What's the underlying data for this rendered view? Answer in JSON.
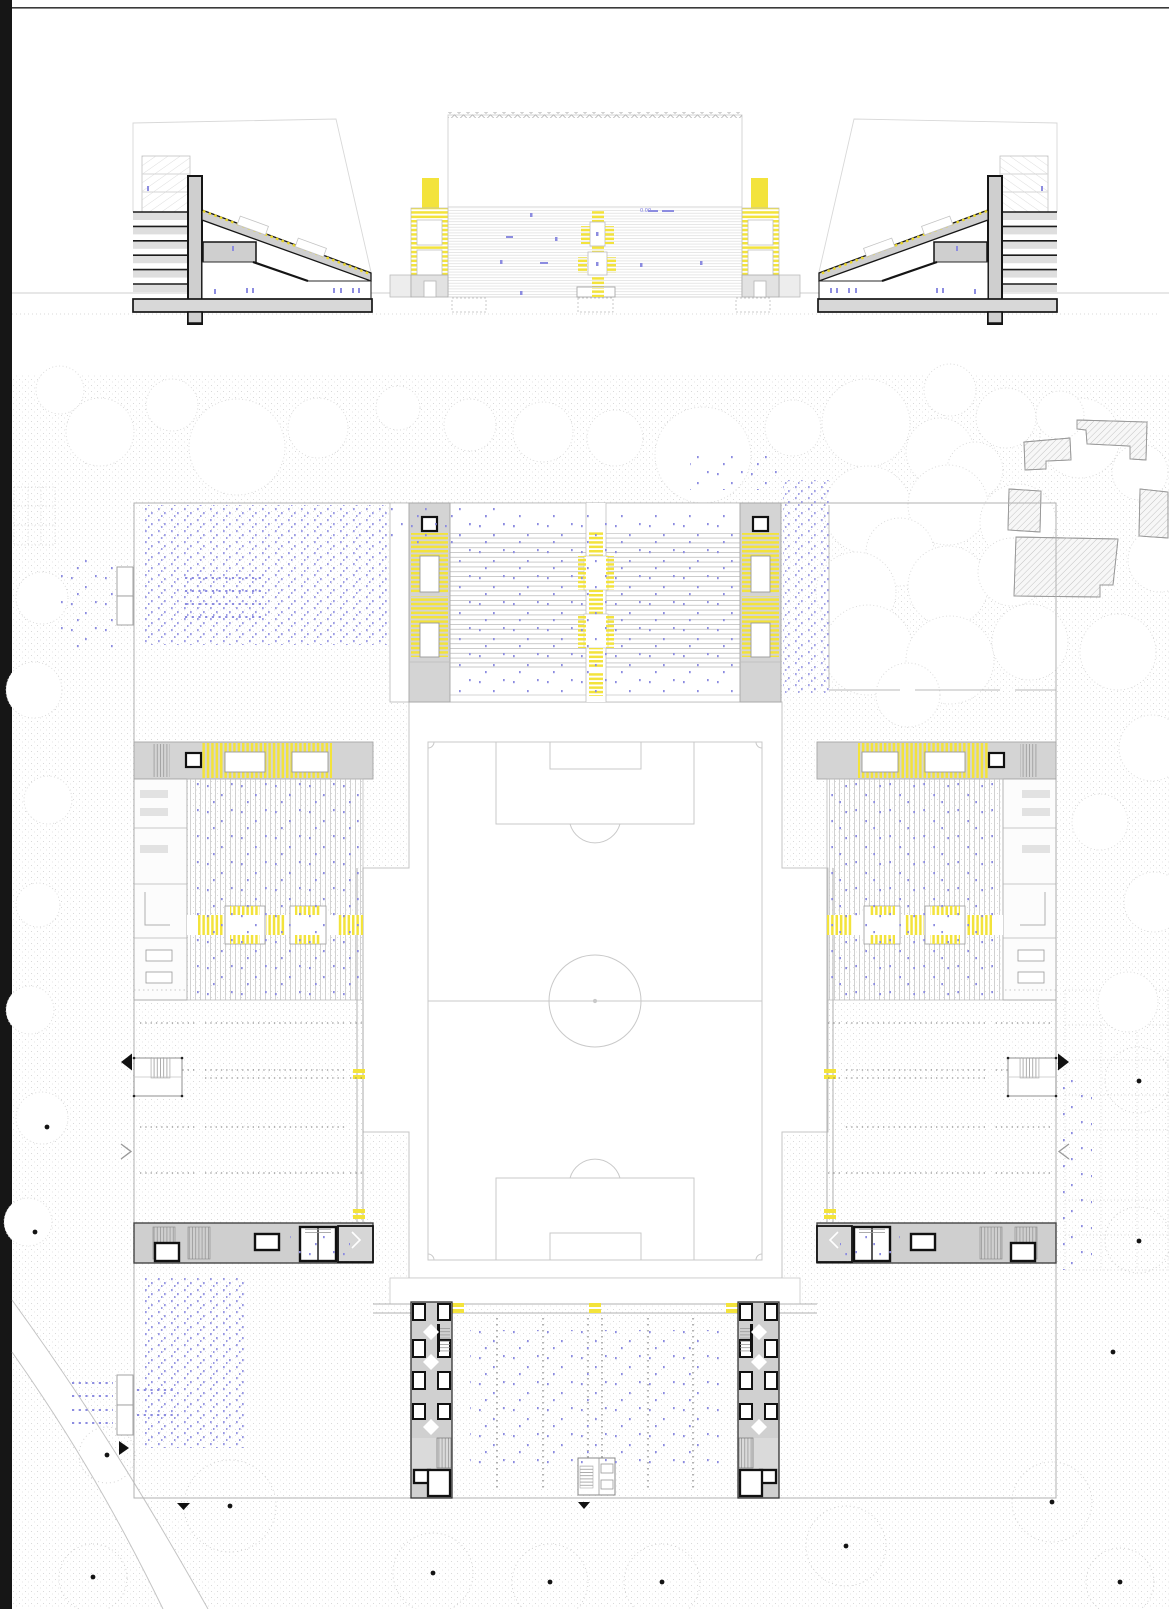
{
  "drawing": {
    "elevation_level_note": "0.00",
    "panels": {
      "section_left": "grandstand-section-west",
      "elevation_center": "stand-elevation",
      "section_right": "grandstand-section-east",
      "site_plan": "stadium-site-plan"
    },
    "colors": {
      "accent_yellow": "#f3e33b",
      "accent_yellow_dash": "#ecd827",
      "annotation_blue": "#8c8ce0",
      "dark_line": "#1b1b1b",
      "gray_fill": "#d3d3d3",
      "light_line": "#c6c6c6",
      "texture_dot": "#d2d2d2",
      "paper": "#ffffff"
    },
    "icons": {
      "section_marker_down": "triangle-down-icon",
      "section_marker_left": "triangle-left-icon",
      "section_marker_right": "triangle-right-icon",
      "direction_chevron": "chevron-icon"
    }
  }
}
